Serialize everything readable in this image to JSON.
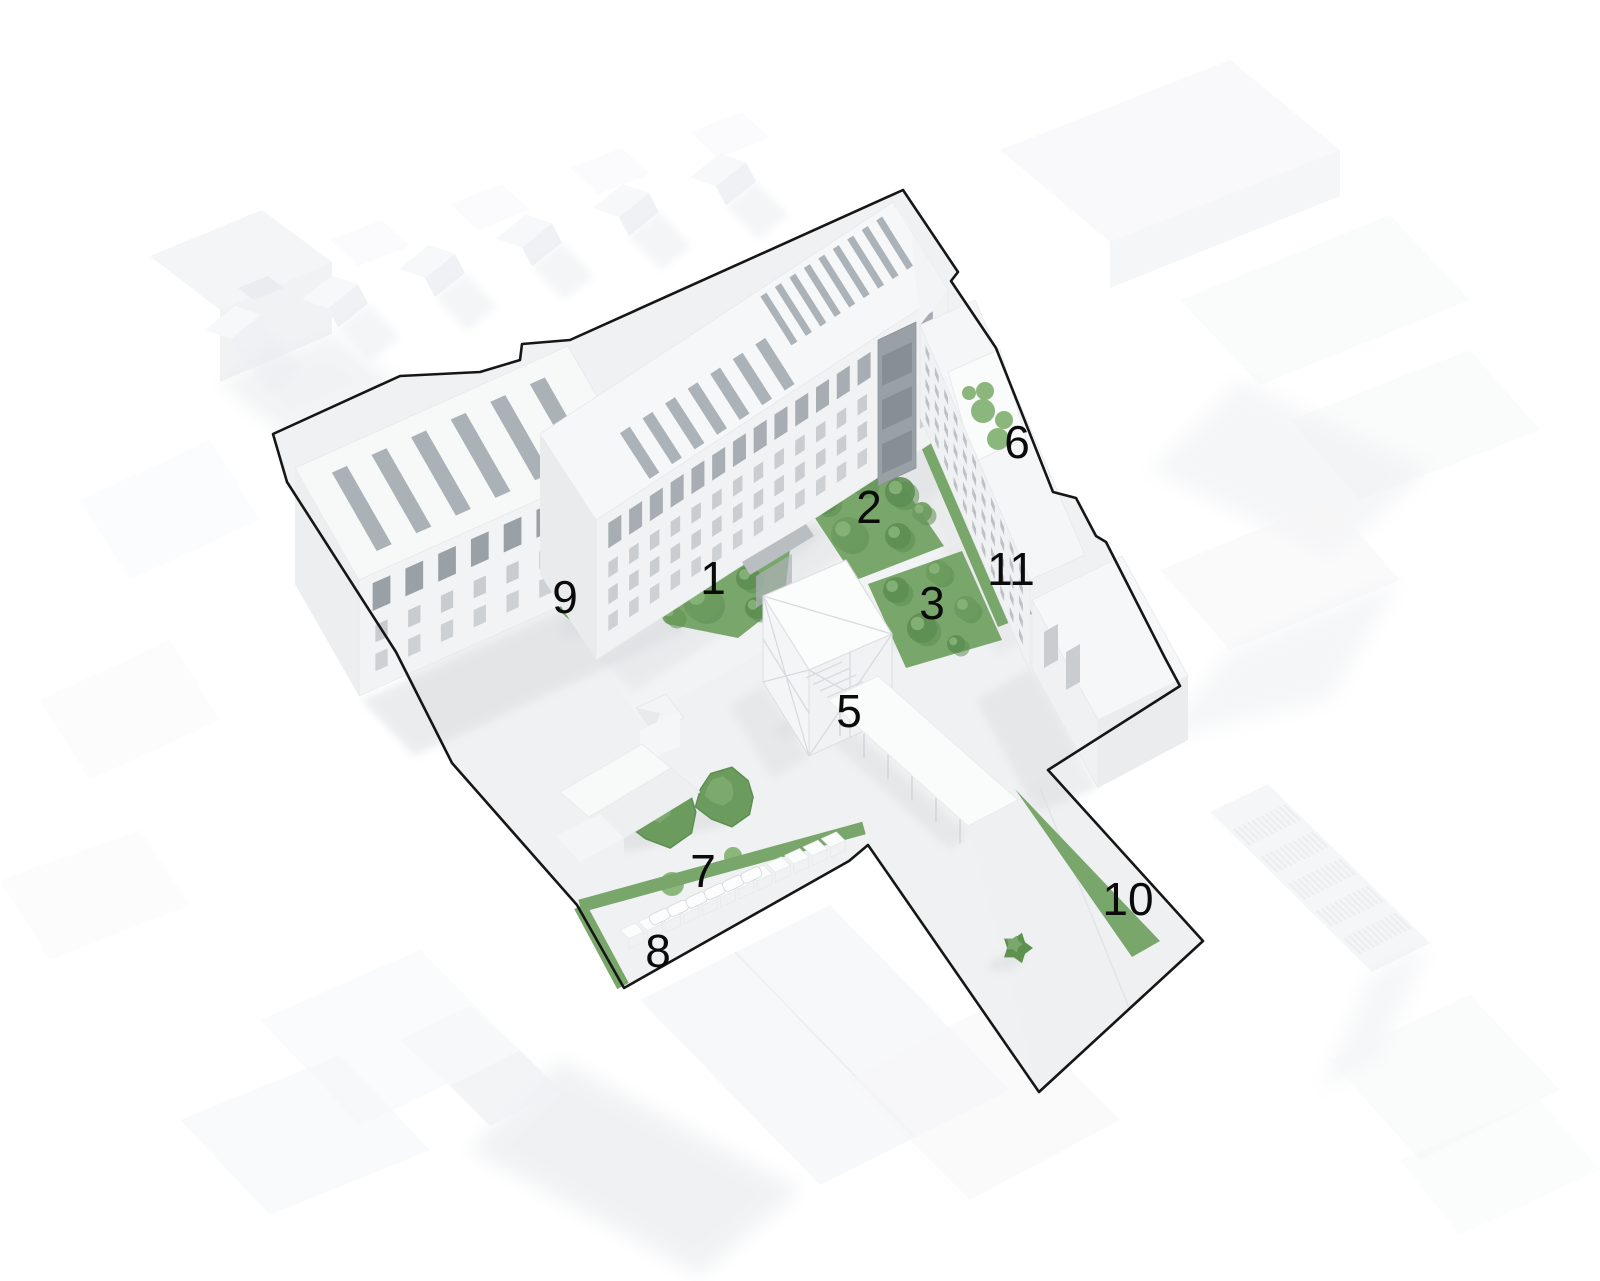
{
  "figure": {
    "type": "axonometric-site-diagram",
    "background": "#ffffff",
    "site_outline_color": "#161616",
    "green": "#79A66B",
    "green_dark": "#5D8E52",
    "green_mid": "#6B9B5D",
    "green_light": "#8BB67C",
    "label_color": "#0b0b0b",
    "label_font_px": 46
  },
  "areas": [
    {
      "label": "1",
      "kind": "lawn-with-trees",
      "label_xy": [
        713,
        578
      ],
      "polygon": [
        [
          628,
          566
        ],
        [
          733,
          519
        ],
        [
          790,
          549
        ],
        [
          784,
          602
        ],
        [
          738,
          638
        ],
        [
          668,
          624
        ]
      ],
      "trees": [
        [
          662,
          588,
          16
        ],
        [
          697,
          560,
          14
        ],
        [
          730,
          548,
          12
        ],
        [
          702,
          602,
          19
        ],
        [
          748,
          578,
          12
        ],
        [
          672,
          615,
          10
        ],
        [
          756,
          608,
          11
        ]
      ]
    },
    {
      "label": "2",
      "kind": "lawn-with-trees",
      "label_xy": [
        869,
        507
      ],
      "polygon": [
        [
          797,
          491
        ],
        [
          888,
          464
        ],
        [
          944,
          546
        ],
        [
          856,
          580
        ]
      ],
      "trees": [
        [
          824,
          500,
          14
        ],
        [
          862,
          482,
          13
        ],
        [
          900,
          492,
          15
        ],
        [
          848,
          534,
          17
        ],
        [
          898,
          536,
          13
        ],
        [
          922,
          512,
          10
        ]
      ]
    },
    {
      "label": "3",
      "kind": "lawn-with-trees",
      "label_xy": [
        932,
        603
      ],
      "polygon": [
        [
          868,
          584
        ],
        [
          962,
          551
        ],
        [
          1002,
          640
        ],
        [
          906,
          668
        ]
      ],
      "trees": [
        [
          896,
          590,
          13
        ],
        [
          938,
          572,
          12
        ],
        [
          922,
          628,
          15
        ],
        [
          966,
          608,
          12
        ],
        [
          956,
          644,
          9
        ]
      ]
    },
    {
      "label": "5",
      "kind": "lawn-with-trees",
      "label_xy": [
        849,
        711
      ],
      "polygon": [
        [
          806,
          700
        ],
        [
          846,
          672
        ],
        [
          886,
          700
        ],
        [
          848,
          738
        ]
      ],
      "trees": [
        [
          830,
          696,
          10
        ],
        [
          856,
          690,
          9
        ],
        [
          848,
          716,
          11
        ]
      ]
    },
    {
      "label": "6",
      "kind": "roof-planters",
      "label_xy": [
        1017,
        442
      ],
      "circles": [
        [
          969,
          393,
          7
        ],
        [
          985,
          391,
          9
        ],
        [
          983,
          411,
          12
        ],
        [
          1004,
          420,
          9
        ],
        [
          998,
          439,
          11
        ]
      ]
    },
    {
      "label": "7",
      "kind": "large-trees",
      "label_xy": [
        703,
        871
      ],
      "canopies": [
        [
          663,
          812,
          40
        ],
        [
          726,
          797,
          33
        ]
      ],
      "circles": [
        [
          672,
          884,
          12
        ],
        [
          733,
          856,
          9
        ]
      ]
    },
    {
      "label": "8",
      "kind": "green-strip",
      "label_xy": [
        658,
        951
      ],
      "polyline": [
        [
          864,
          828
        ],
        [
          580,
          906
        ],
        [
          623,
          986
        ]
      ],
      "width": 13
    },
    {
      "label": "9",
      "kind": "green-sliver",
      "label_xy": [
        565,
        597
      ],
      "polygon": [
        [
          549,
          599
        ],
        [
          557,
          590
        ],
        [
          590,
          634
        ],
        [
          566,
          617
        ]
      ]
    },
    {
      "label": "10",
      "kind": "green-wedge",
      "label_xy": [
        1128,
        899
      ],
      "polygon": [
        [
          1015,
          789
        ],
        [
          1160,
          941
        ],
        [
          1132,
          957
        ]
      ]
    },
    {
      "label": "11",
      "kind": "lawn-strip",
      "label_xy": [
        1011,
        569
      ],
      "polygon": [
        [
          918,
          440
        ],
        [
          952,
          428
        ],
        [
          1032,
          614
        ],
        [
          998,
          627
        ]
      ]
    }
  ],
  "street_tree": {
    "xy": [
      1017,
      948
    ],
    "r": 16
  }
}
